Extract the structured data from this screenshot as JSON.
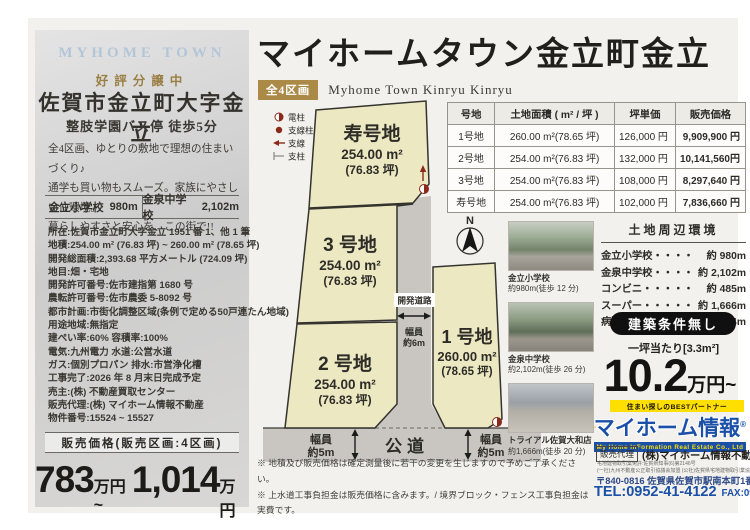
{
  "header": {
    "title": "マイホームタウン金立町金立",
    "badge": "全4区画",
    "subtitle": "Myhome Town Kinryu Kinryu"
  },
  "left_panel": {
    "brand": "MYHOME TOWN",
    "status": "好評分譲中",
    "address_title": "佐賀市金立町大字金立",
    "access": "整肢学園バス停 徒歩5分",
    "description": [
      "全4区画、ゆとりの敷地で理想の住まいづくり♪",
      "通学も買い物もスムーズ。家族にやさしい住環境。",
      "暮らしやすさと安心を、この街で!!"
    ],
    "schools": [
      {
        "name": "金立小学校",
        "distance": "980m"
      },
      {
        "name": "金泉中学校",
        "distance": "2,102m"
      }
    ],
    "specs": [
      "所在:佐賀市金立町大字金立 1951 番 1、他 1 筆",
      "地積:254.00 m² (76.83 坪) ~ 260.00 m² (78.65 坪)",
      "開発総面積:2,393.68 平方メートル (724.09 坪)",
      "地目:畑・宅地",
      "開発許可番号:佐市建指第 1680 号",
      "農転許可番号:佐市農委 5-8092 号",
      "都市計画:市街化調整区域(条例で定める50戸連たん地域)",
      "用途地域:無指定",
      "建ぺい率:60%  容積率:100%",
      "電気:九州電力  水道:公営水道",
      "ガス:個別プロパン  排水:市営浄化槽",
      "工事完了:2026 年 8 月末日完成予定",
      "売主:(株) 不動産買取センター",
      "販売代理:(株) マイホーム情報不動産",
      "物件番号:15524 ~ 15527"
    ],
    "price_band": "販売価格(販売区画:4区画)",
    "price": {
      "from": "783",
      "from_unit": "万円~",
      "to": "1,014",
      "to_unit": "万円"
    }
  },
  "price_table": {
    "headers": [
      "号地",
      "土地面積 ( m² / 坪 )",
      "坪単価",
      "販売価格"
    ],
    "rows": [
      [
        "1号地",
        "260.00 m²(78.65 坪)",
        "126,000 円",
        "9,909,900 円"
      ],
      [
        "2号地",
        "254.00 m²(76.83 坪)",
        "132,000 円",
        "10,141,560円"
      ],
      [
        "3号地",
        "254.00 m²(76.83 坪)",
        "108,000 円",
        "8,297,640 円"
      ],
      [
        "寿号地",
        "254.00 m²(76.83 坪)",
        "102,000 円",
        "7,836,660 円"
      ]
    ]
  },
  "site_map": {
    "legend": [
      {
        "label": "電柱"
      },
      {
        "label": "支線柱"
      },
      {
        "label": "支線"
      },
      {
        "label": "支柱"
      }
    ],
    "compass": "N",
    "plots": [
      {
        "name": "寿号地",
        "area": "254.00 m²",
        "tsubo": "(76.83 坪)"
      },
      {
        "name": "3 号地",
        "area": "254.00 m²",
        "tsubo": "(76.83 坪)"
      },
      {
        "name": "2 号地",
        "area": "254.00 m²",
        "tsubo": "(76.83 坪)"
      },
      {
        "name": "1 号地",
        "area": "260.00 m²",
        "tsubo": "(78.65 坪)"
      }
    ],
    "dev_road": {
      "name": "開発道路",
      "width_1": "幅員",
      "width_2": "約6m"
    },
    "public_road": {
      "name": "公道",
      "width_1": "幅員",
      "width_2": "約5m"
    },
    "notes": [
      "※ 地積及び販売価格は確定測量後に若干の変更を生じますので予めご了承ください。",
      "※ 上水道工事負担金は販売価格に含みます。/ 境界ブロック・フェンス工事負担金は実費です。"
    ]
  },
  "photos": [
    {
      "name": "金立小学校",
      "distance": "約980m(徒歩 12 分)"
    },
    {
      "name": "金泉中学校",
      "distance": "約2,102m(徒歩 26 分)"
    },
    {
      "name": "トライアル佐賀大和店",
      "distance": "約1,666m(徒歩 20 分)"
    }
  ],
  "surroundings": {
    "title": "土地周辺環境",
    "rows": [
      {
        "label": "金立小学校・・・・",
        "value": "約 980m"
      },
      {
        "label": "金泉中学校・・・・",
        "value": "約 2,102m"
      },
      {
        "label": "コンビニ・・・・・",
        "value": "約 485m"
      },
      {
        "label": "スーパー・・・・・",
        "value": "約 1,666m"
      },
      {
        "label": "病院 ・・・・・・",
        "value": "約 2,464m"
      }
    ]
  },
  "offer": {
    "no_conditions": "建築条件無し",
    "per_tsubo": "一坪当たり[3.3m²]",
    "price": "10.2",
    "price_unit": "万円~"
  },
  "company": {
    "tagline": "住まい探しのBESTパートナー",
    "logo": "マイホーム情報",
    "logo_reg": "®",
    "logo_sub": "My Home InFormation Real Estate Co., Ltd",
    "agent_label": "販売代理",
    "agent_name": "(株)マイホーム情報不動産 佐賀本店",
    "license_lines": [
      "宅地建物取引業免許:佐賀県知事(6)第2146号",
      "(一社)九州不動産公正取引協議会加盟 (公社)佐賀県宅地建物取引業協会会員"
    ],
    "address": "〒840-0816 佐賀県佐賀市駅南本町1番20号",
    "tel": "TEL:0952-41-4122",
    "fax": "FAX:0952-41-4118"
  },
  "colors": {
    "gold": "#ab8a48",
    "dark_red": "#8b2a1a",
    "blue": "#1b50a8",
    "yellow": "#ffdf00",
    "plot_fill": "#ebe8c2",
    "road_fill": "#c9c6c2"
  }
}
